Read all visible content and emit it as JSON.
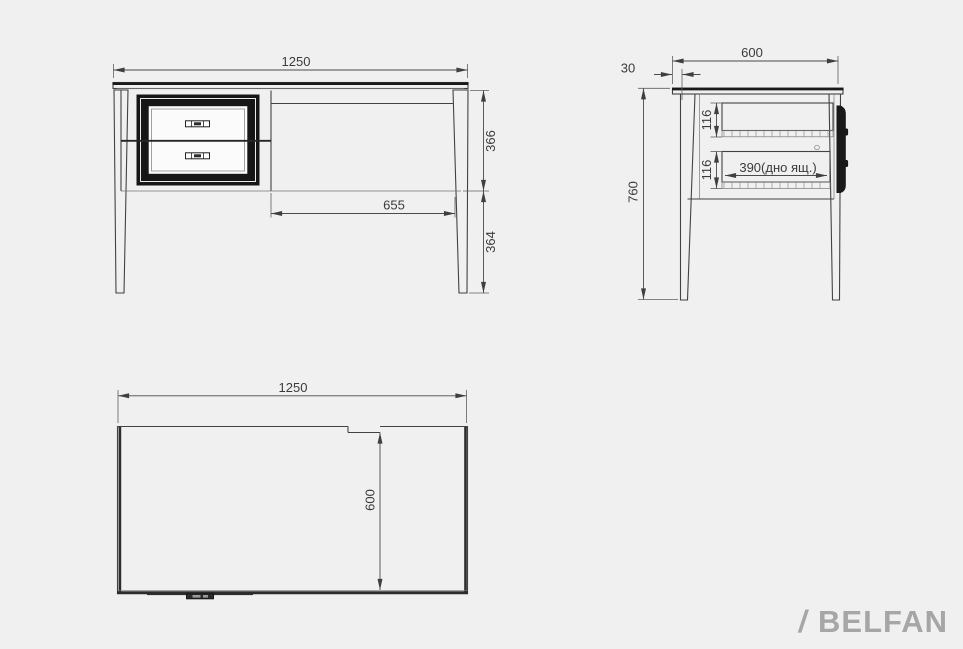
{
  "colors": {
    "background": "#f0f0f1",
    "outline": "#424242",
    "dimension_text": "#3b3b3b",
    "drawer_frame_black": "#161616",
    "logo_gray": "#a6a6a6"
  },
  "front_view": {
    "overall_width": "1250",
    "carcass_height": "366",
    "leg_height": "364",
    "kneehole_width": "655"
  },
  "side_view": {
    "top_depth": "600",
    "top_overhang": "30",
    "overall_height": "760",
    "upper_drawer_inner_height": "116",
    "lower_drawer_inner_height": "116",
    "drawer_bottom_depth": "390(дно ящ.)"
  },
  "top_view": {
    "overall_width": "1250",
    "overall_depth": "600"
  },
  "logo": {
    "slash": "/",
    "text": "BELFAN"
  }
}
